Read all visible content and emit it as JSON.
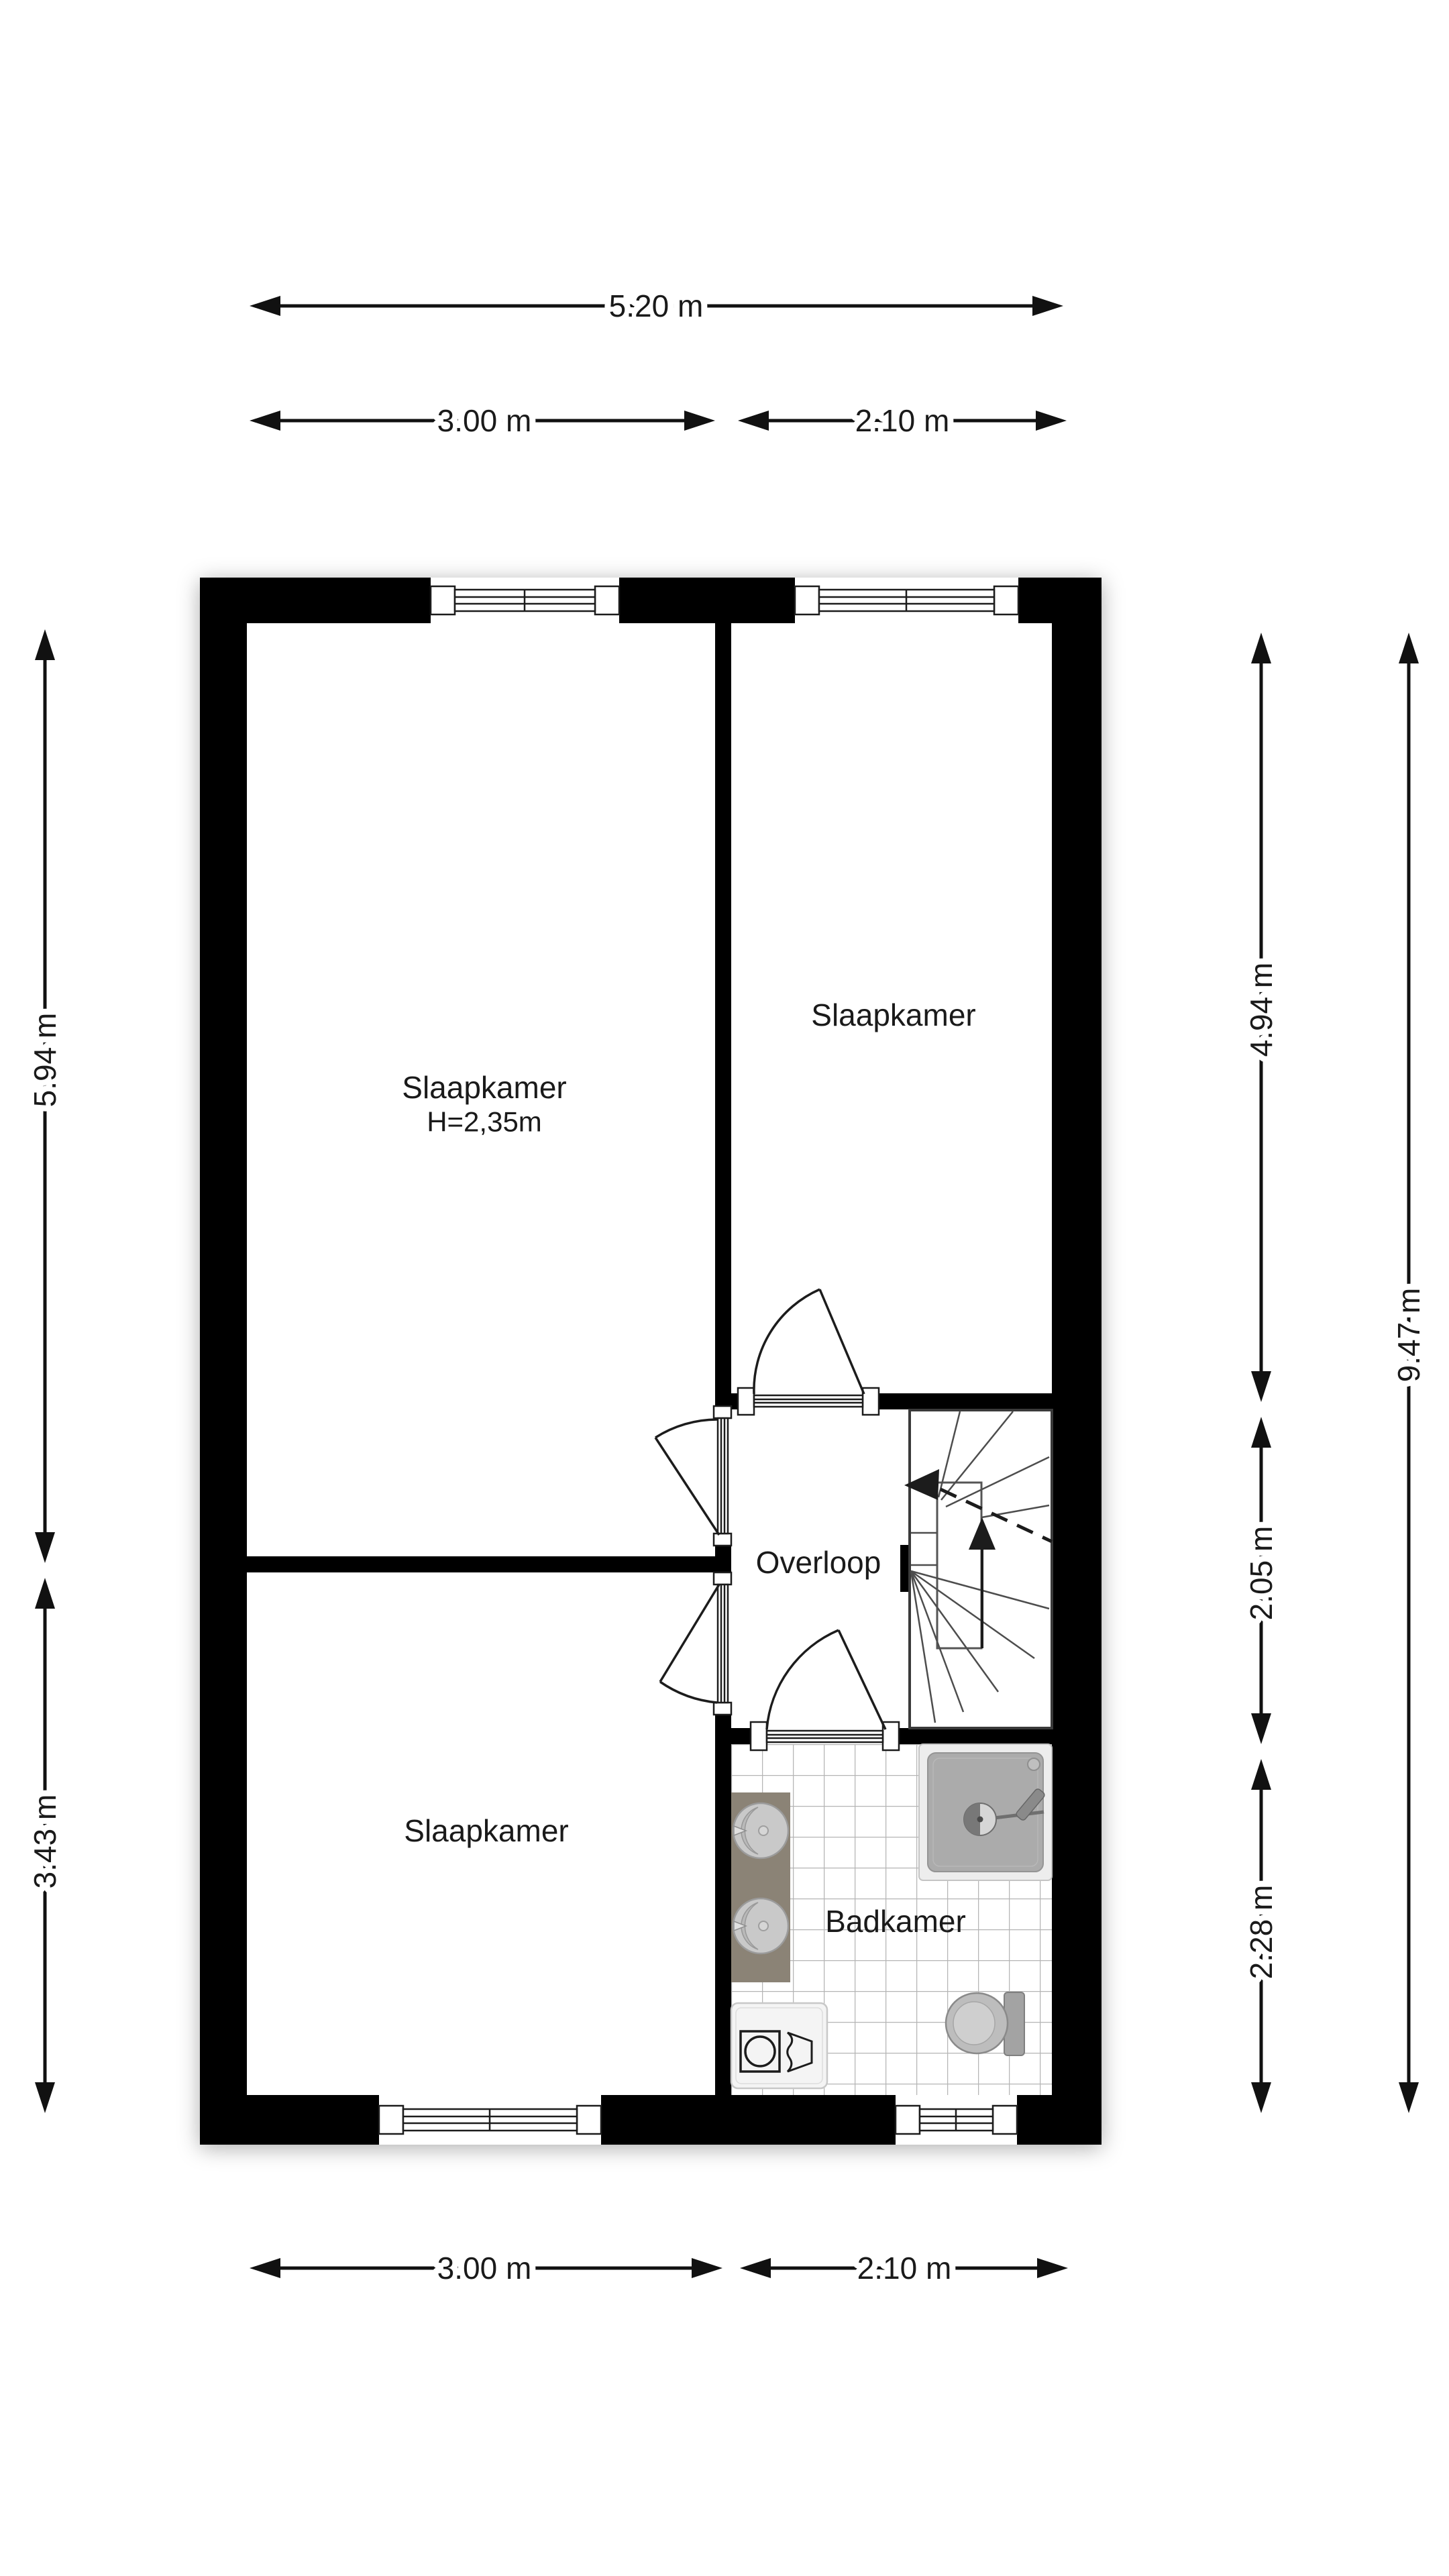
{
  "floorplan": {
    "rooms": {
      "bedroom_main": {
        "label": "Slaapkamer",
        "ceiling_height": "H=2,35m"
      },
      "bedroom_right": {
        "label": "Slaapkamer"
      },
      "bedroom_lower": {
        "label": "Slaapkamer"
      },
      "landing": {
        "label": "Overloop"
      },
      "bathroom": {
        "label": "Badkamer"
      }
    },
    "dimensions": {
      "top_total": "5.20 m",
      "top_left": "3.00 m",
      "top_right": "2.10 m",
      "bottom_left": "3.00 m",
      "bottom_right": "2.10 m",
      "left_upper": "5.94 m",
      "left_lower": "3.43 m",
      "right_upper": "4.94 m",
      "right_middle": "2.05 m",
      "right_lower": "2.28 m",
      "right_total": "9.47 m"
    },
    "colors": {
      "wall": "#000000",
      "dimension_line": "#111111",
      "vanity": "#8b8376",
      "fixture_gray": "#ababab",
      "tile_grout": "#b5b5b5"
    }
  }
}
